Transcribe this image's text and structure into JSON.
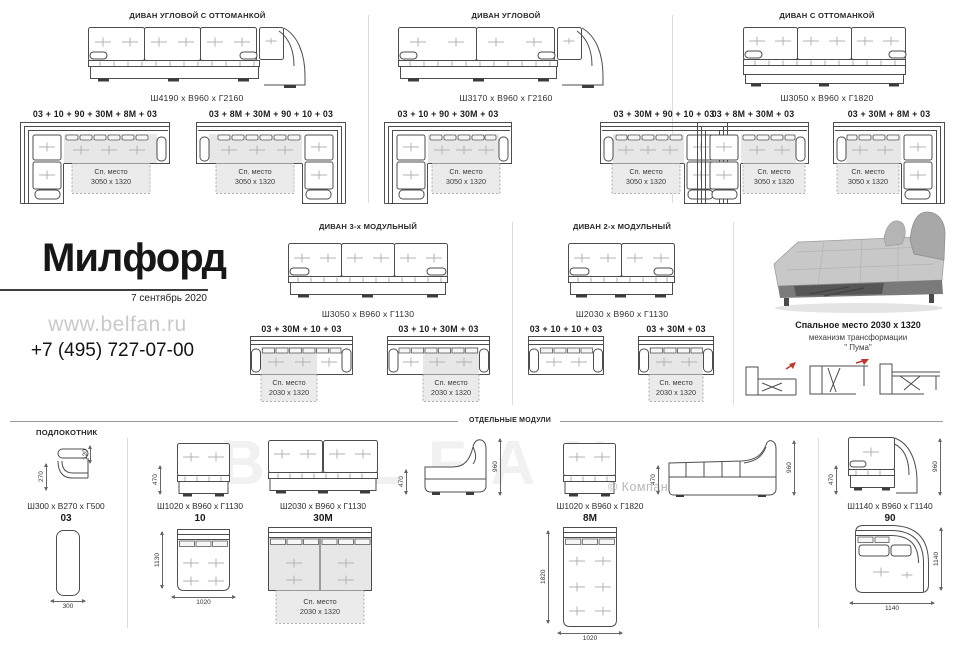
{
  "top_sections": [
    {
      "title": "ДИВАН УГЛОВОЙ С ОТТОМАНКОЙ",
      "dims": "Ш4190 x В960 x Г2160",
      "configs": [
        {
          "label": "03 + 10 + 90 + 30М + 8М + 03",
          "sleep_title": "Сп. место",
          "sleep_size": "3050 x 1320"
        },
        {
          "label": "03 + 8М + 30М + 90 + 10 + 03",
          "sleep_title": "Сп. место",
          "sleep_size": "3050 x 1320"
        }
      ]
    },
    {
      "title": "ДИВАН УГЛОВОЙ",
      "dims": "Ш3170 x В960 x Г2160",
      "configs": [
        {
          "label": "03 + 10 + 90 + 30М + 03",
          "sleep_title": "Сп. место",
          "sleep_size": "3050 x 1320"
        },
        {
          "label": "03 + 30М + 90 + 10 + 03",
          "sleep_title": "Сп. место",
          "sleep_size": "3050 x 1320"
        }
      ]
    },
    {
      "title": "ДИВАН С ОТТОМАНКОЙ",
      "dims": "Ш3050 x В960 x Г1820",
      "configs": [
        {
          "label": "03 + 8М + 30М + 03",
          "sleep_title": "Сп. место",
          "sleep_size": "3050 x 1320"
        },
        {
          "label": "03 + 30М + 8М + 03",
          "sleep_title": "Сп. место",
          "sleep_size": "3050 x 1320"
        }
      ]
    }
  ],
  "brand": {
    "title": "Милфорд",
    "date": "7 сентябрь 2020",
    "site": "www.belfan.ru",
    "phone": "+7 (495) 727-07-00"
  },
  "mid_sections": [
    {
      "title": "ДИВАН 3-х МОДУЛЬНЫЙ",
      "dims": "Ш3050 x В960 x Г1130",
      "configs": [
        {
          "label": "03 + 30М + 10 + 03",
          "sleep_title": "Сп. место",
          "sleep_size": "2030 x 1320"
        },
        {
          "label": "03 + 10 + 30М + 03",
          "sleep_title": "Сп. место",
          "sleep_size": "2030 x 1320"
        }
      ]
    },
    {
      "title": "ДИВАН 2-х МОДУЛЬНЫЙ",
      "dims": "Ш2030 x В960 x Г1130",
      "configs": [
        {
          "label": "03 + 10 + 10 + 03"
        },
        {
          "label": "03 + 30М + 03",
          "sleep_title": "Сп. место",
          "sleep_size": "2030 x 1320"
        }
      ]
    }
  ],
  "photo": {
    "line1": "Спальное место 2030 x 1320",
    "line2": "механизм трансформации",
    "line3": "\" Пума\""
  },
  "bottom": {
    "armrest_title": "ПОДЛОКОТНИК",
    "modules_title": "ОТДЕЛЬНЫЕ МОДУЛИ",
    "watermark": "© Компания БЕЛФАН",
    "big_watermark": "BELFAN",
    "armrest": {
      "dims": "Ш300 x В270 x Г500",
      "code": "03",
      "d_depth": "270",
      "d_top": "120",
      "d_width": "300"
    },
    "m10": {
      "dims": "Ш1020 x В960 x Г1130",
      "code": "10",
      "d_front": "470",
      "d_depth": "1130",
      "d_width": "1020"
    },
    "m30": {
      "dims": "Ш2030 x В960 x Г1130",
      "code": "30М",
      "sleep_title": "Сп. место",
      "sleep_size": "2030 x 1320"
    },
    "side": {
      "d_seat": "470",
      "d_back": "960"
    },
    "m8": {
      "dims": "Ш1020 x В960 x Г1820",
      "code": "8М",
      "d_depth": "1820",
      "d_width": "1020",
      "d_side": "470",
      "d_back": "960"
    },
    "m90": {
      "dims": "Ш1140 x В960 x Г1140",
      "code": "90",
      "d_seat": "470",
      "d_back": "960",
      "d_depth": "1140",
      "d_width": "1140"
    }
  }
}
